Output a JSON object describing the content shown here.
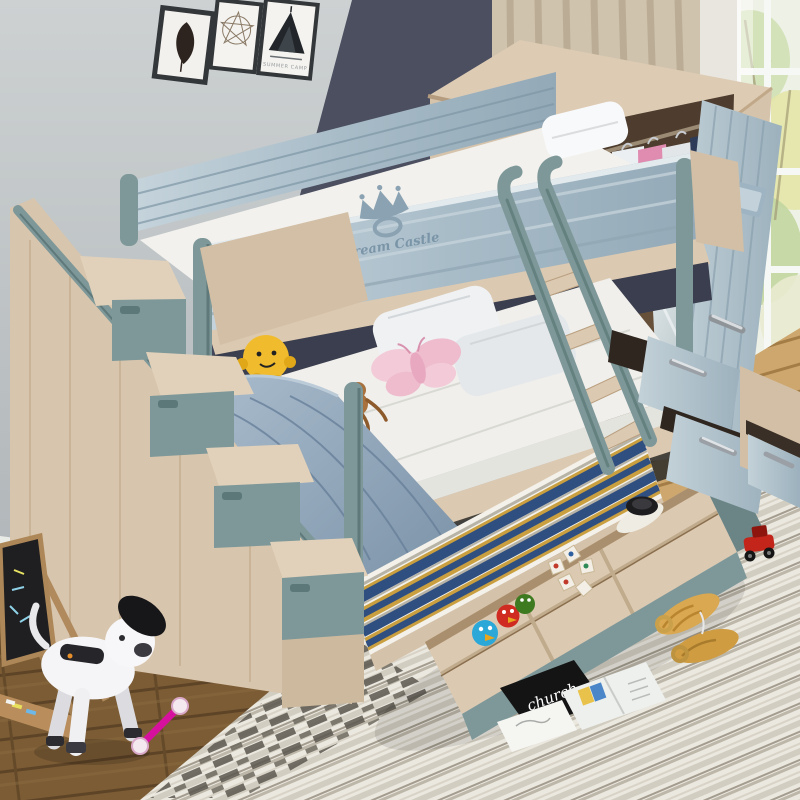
{
  "scene": {
    "type": "product-photo",
    "subject": "Kids bunk bed set with storage staircase, trundle drawers and mirrored wardrobe in a child's bedroom",
    "texts": {
      "poster_label": "SUMMER CAMP",
      "bed_brand": "Dream Castle",
      "magazine_cover": "church"
    },
    "palette": {
      "wall": "#bfc5c8",
      "accent_wall": "#4b4f60",
      "wood_light": "#d8c5ad",
      "teal": "#7e9899",
      "rail_bluewash": "#aec2cd",
      "floor_dark": "#7c5c35",
      "floor_light": "#cda76d",
      "rug": "#ebe8e0",
      "blanket": "#8fa3b6",
      "stripe_blue": "#2f4f80",
      "stripe_mustard": "#ca9f3f"
    },
    "objects": [
      "wall-frames",
      "window",
      "curtain",
      "wardrobe-with-mirror",
      "hanging-clothes",
      "storage-staircase",
      "top-bunk",
      "guard-rail-crown-logo",
      "lower-bed",
      "ladder",
      "trundle-striped-mattress",
      "storage-drawer",
      "angry-bird-toys",
      "wooden-blocks",
      "black-bowl",
      "robot-dog-toy",
      "chalkboard-easel",
      "butterfly-plush",
      "monkey-figurine",
      "yellow-plush",
      "pillows",
      "magazines",
      "woven-sandals",
      "red-toy-car",
      "pink-dumbbell-toy"
    ]
  }
}
